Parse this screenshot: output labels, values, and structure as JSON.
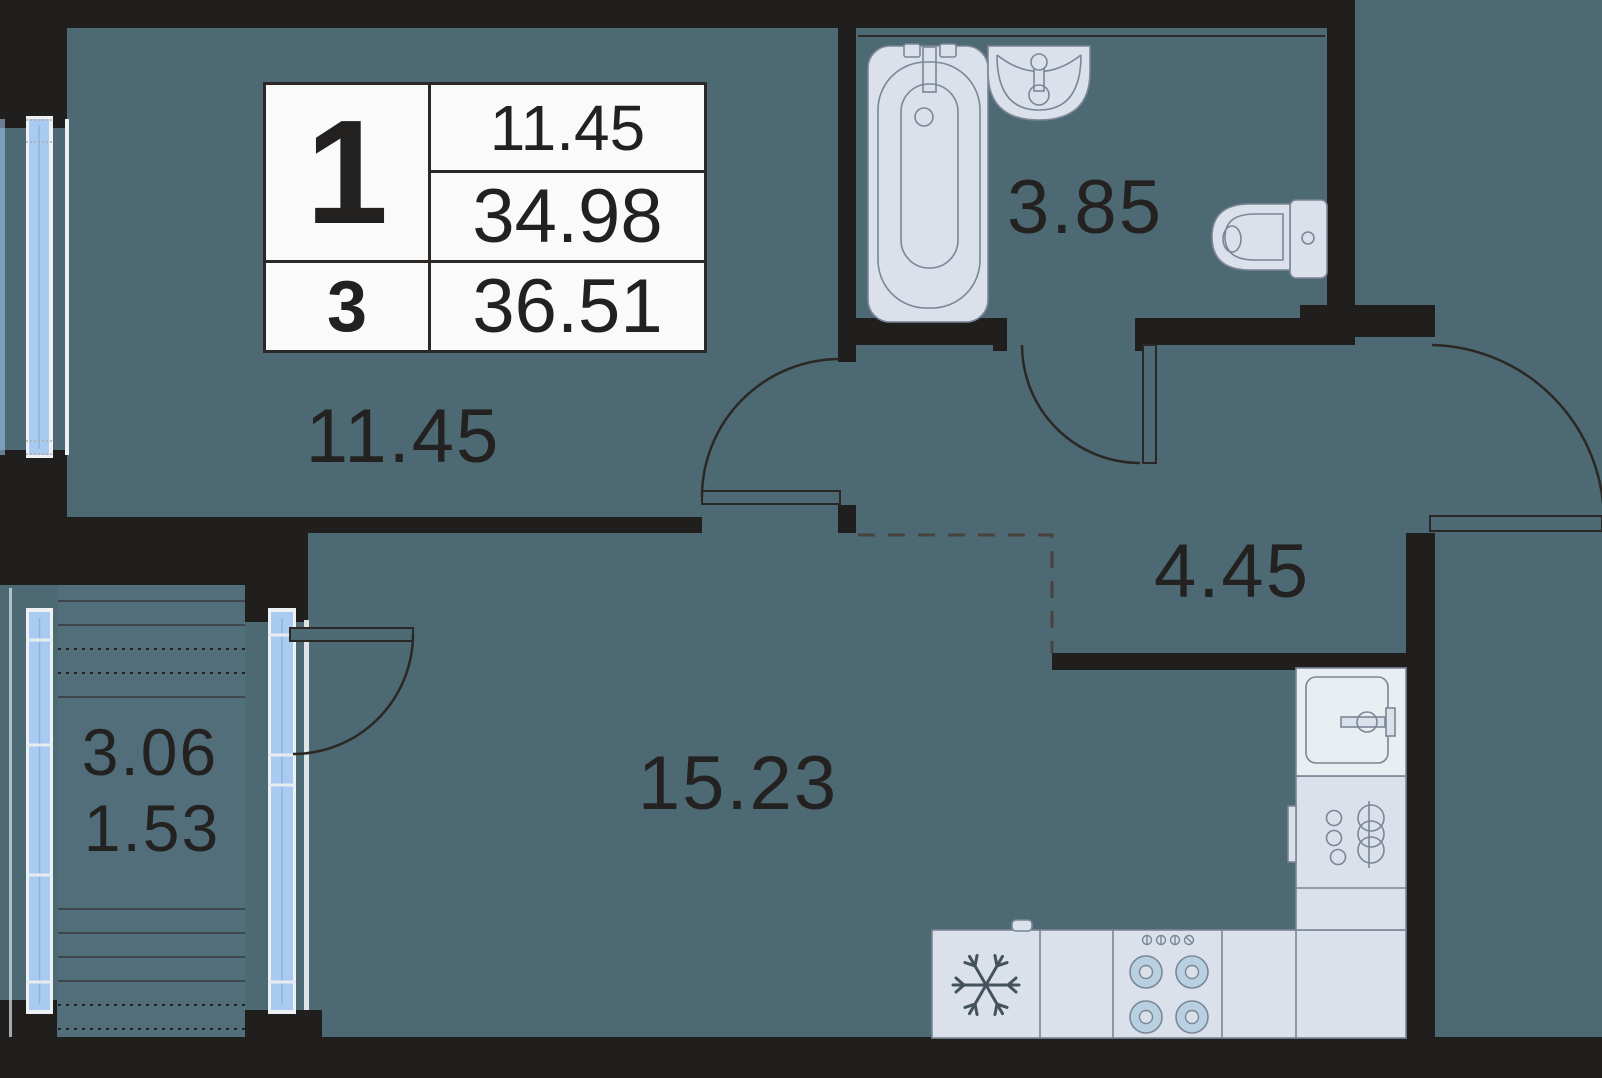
{
  "unit_card": {
    "left_top": "1",
    "left_bottom": "3",
    "right_rows": [
      "11.45",
      "34.98",
      "36.51"
    ]
  },
  "rooms": {
    "bedroom": "11.45",
    "bathroom": "3.85",
    "hallway": "4.45",
    "living_kitchen": "15.23",
    "balcony_full": "3.06",
    "balcony_reduced": "1.53"
  },
  "fixtures": [
    "bathtub",
    "washbasin",
    "toilet",
    "refrigerator",
    "stove",
    "kitchen-sink",
    "hob",
    "snowflake-icon"
  ],
  "colors": {
    "background": "#4d6973",
    "wall": "#211f1e",
    "window_glass": "#a9cbf2",
    "fixture_fill": "#dbe1ea",
    "fixture_stroke": "#7b8696",
    "burner_fill": "#b9cfe2",
    "text": "#242220",
    "table_background": "#fafafa"
  }
}
